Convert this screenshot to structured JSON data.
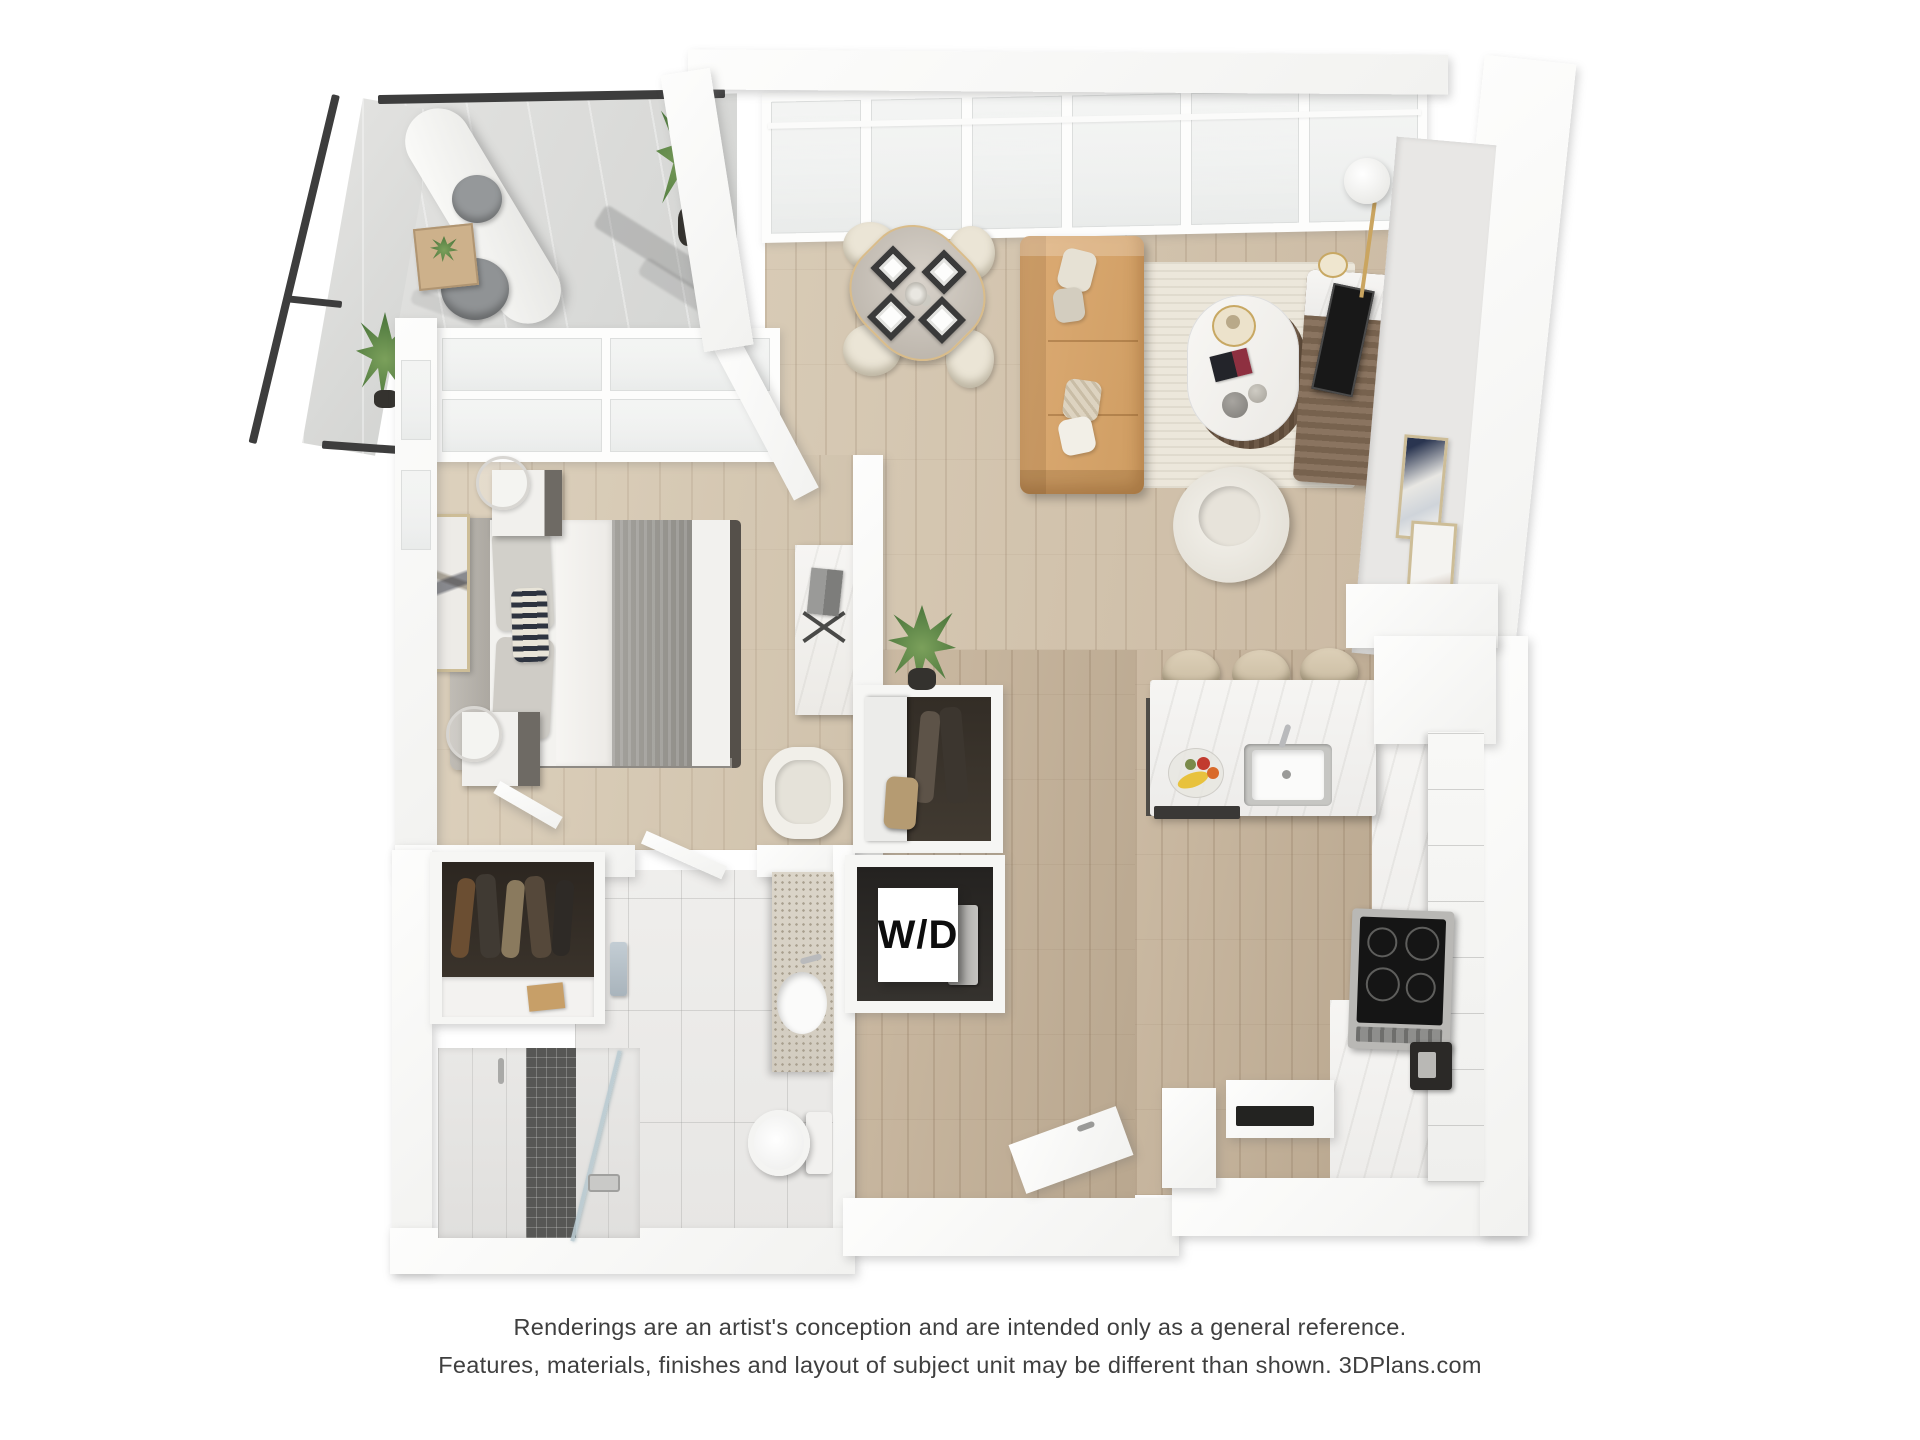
{
  "labels": {
    "washer_dryer": "W/D"
  },
  "disclaimer": {
    "line1": "Renderings are an artist's conception and are intended only as a general reference.",
    "line2": "Features, materials, finishes and layout of subject unit may be different than shown. 3DPlans.com"
  },
  "palette": {
    "background": "#ffffff",
    "wall": "#f7f7f5",
    "balcony_frame": "#3d3d3d",
    "balcony_floor": "#dcdddb",
    "wood_living": "#d2c4ae",
    "wood_hall": "#c2b099",
    "wood_bedroom": "#d7cab6",
    "bath_tile": "#ebeae8",
    "kitchen_marble": "#f3f2f0",
    "shower_accent": "#575755",
    "closet_interior": "#332d26",
    "sofa_tan": "#d8a76f",
    "rug_cream": "#ece7db",
    "plant_green": "#4c7a3f",
    "disclaimer_text": "#3f3f3f",
    "wd_text": "#0d0d0d"
  }
}
